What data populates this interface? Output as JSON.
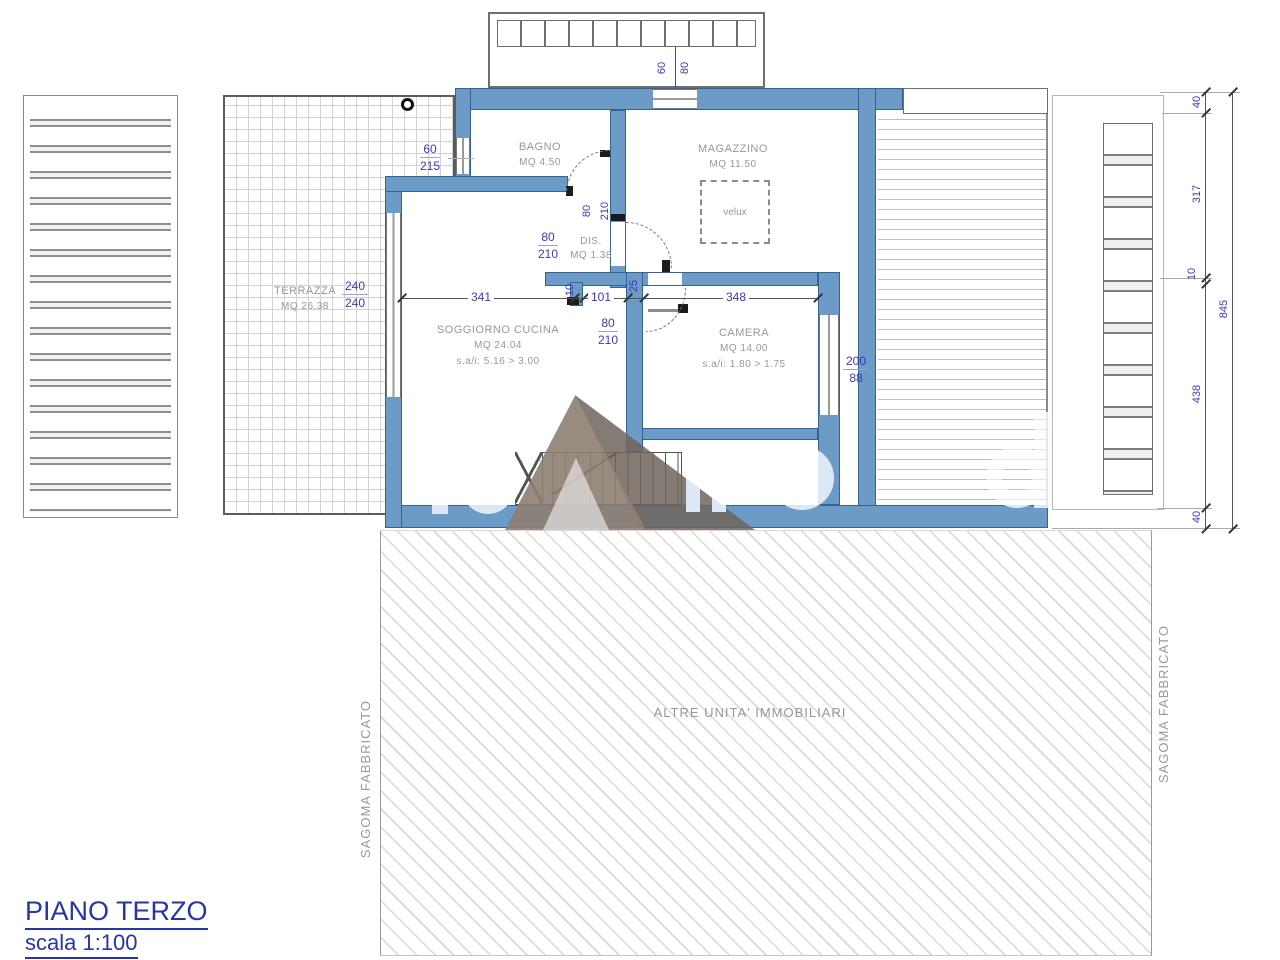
{
  "title_block": {
    "title": "PIANO TERZO",
    "scale": "scala 1:100"
  },
  "rooms": {
    "bagno": {
      "name": "BAGNO",
      "area": "MQ 4.50"
    },
    "magazzino": {
      "name": "MAGAZZINO",
      "area": "MQ 11.50"
    },
    "dis": {
      "name": "DIS.",
      "area": "MQ 1.38"
    },
    "terrazza": {
      "name": "TERRAZZA",
      "area": "MQ 26.38"
    },
    "soggiorno": {
      "name": "SOGGIORNO CUCINA",
      "area": "MQ 24.04",
      "heights": "s.a/i: 5.16 > 3.00"
    },
    "camera": {
      "name": "CAMERA",
      "area": "MQ 14.00",
      "heights": "s.a/i: 1.80 > 1.75"
    }
  },
  "annotations": {
    "velux": "velux",
    "altre_unita": "ALTRE UNITA' IMMOBILIARI",
    "sagoma_left": "SAGOMA FABBRICATO",
    "sagoma_right": "SAGOMA FABBRICATO"
  },
  "dims": {
    "d341": "341",
    "d101": "101",
    "d348": "348",
    "d10": "10",
    "d25": "25",
    "bagno_win_w": "60",
    "bagno_win_h": "215",
    "terr_w": "240",
    "terr_h": "240",
    "door_w": "80",
    "door_h": "210",
    "cam_win_w": "200",
    "cam_win_h": "88",
    "balc_w": "60",
    "balc_h": "80",
    "rc1": "40",
    "rc2": "317",
    "rc3": "10",
    "rc4": "438",
    "rc5": "40",
    "rtot": "845"
  },
  "colors": {
    "wall_fill": "#6d9bc7",
    "wall_border": "#35638f",
    "dim_text": "#3a3ab8",
    "room_text": "#979797",
    "title_text": "#2635a9",
    "hatch_line": "#d8d8d8",
    "watermark_blue": "#dce8f5",
    "watermark_brown": "#8d7e72"
  }
}
